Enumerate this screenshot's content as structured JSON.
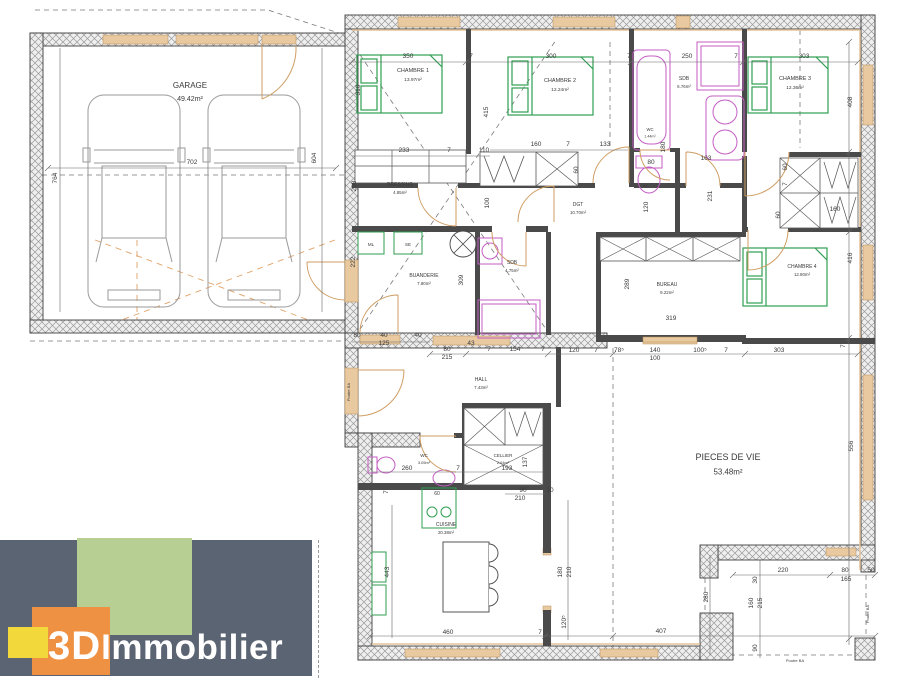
{
  "logo": {
    "bold": "3D",
    "rest": "Immobilier",
    "colors": {
      "panel": "#5b6472",
      "green": "#b7cf92",
      "orange": "#ef9143",
      "yellow": "#f2d83a",
      "text": "#ffffff"
    }
  },
  "palette": {
    "wall_hatch": "#9a9a9a",
    "interior_wall": "#4a4a4a",
    "opening_tan": "#e8c9a0",
    "furniture_green": "#2f9e52",
    "sanitary_magenta": "#c45ec4",
    "door_tan": "#cf9e63"
  },
  "rooms": [
    {
      "name": "GARAGE",
      "area": "49.42m²",
      "x": 190,
      "y": 88,
      "fs": 8
    },
    {
      "name": "CHAMBRE 1",
      "area": "13.97m²",
      "x": 413,
      "y": 72,
      "fs": 5.5
    },
    {
      "name": "CHAMBRE 2",
      "area": "12.24m²",
      "x": 560,
      "y": 82,
      "fs": 5.5
    },
    {
      "name": "SDB",
      "area": "6.76m²",
      "x": 684,
      "y": 80,
      "fs": 5
    },
    {
      "name": "WC",
      "area": "1.44m²",
      "x": 650,
      "y": 131,
      "fs": 4.2
    },
    {
      "name": "CHAMBRE 3",
      "area": "12.36m²",
      "x": 795,
      "y": 80,
      "fs": 5.5
    },
    {
      "name": "DRESSING",
      "area": "4.85m²",
      "x": 400,
      "y": 186,
      "fs": 5
    },
    {
      "name": "DGT",
      "area": "10.70m²",
      "x": 578,
      "y": 206,
      "fs": 5
    },
    {
      "name": "BUANDERIE",
      "area": "7.80m²",
      "x": 424,
      "y": 277,
      "fs": 5
    },
    {
      "name": "SDB",
      "area": "4.75m²",
      "x": 512,
      "y": 264,
      "fs": 5
    },
    {
      "name": "BUREAU",
      "area": "9.22m²",
      "x": 667,
      "y": 286,
      "fs": 5
    },
    {
      "name": "CHAMBRE 4",
      "area": "12.80m²",
      "x": 802,
      "y": 268,
      "fs": 5
    },
    {
      "name": "HALL",
      "area": "7.43m²",
      "x": 481,
      "y": 381,
      "fs": 5
    },
    {
      "name": "WC",
      "area": "3.05m²",
      "x": 424,
      "y": 457,
      "fs": 4.5
    },
    {
      "name": "CELLIER",
      "area": "2.64m²",
      "x": 503,
      "y": 457,
      "fs": 4.5
    },
    {
      "name": "CUISINE",
      "area": "20.38m²",
      "x": 446,
      "y": 526,
      "fs": 5
    },
    {
      "name": "PIECES DE VIE",
      "area": "53.48m²",
      "x": 728,
      "y": 460,
      "fs": 9
    }
  ],
  "annotations": [
    {
      "t": "350",
      "x": 408,
      "y": 58
    },
    {
      "t": "7",
      "x": 471,
      "y": 58
    },
    {
      "t": "300",
      "x": 551,
      "y": 58
    },
    {
      "t": "7",
      "x": 629,
      "y": 58
    },
    {
      "t": "250",
      "x": 687,
      "y": 58
    },
    {
      "t": "7",
      "x": 736,
      "y": 58
    },
    {
      "t": "303",
      "x": 804,
      "y": 58
    },
    {
      "t": "702",
      "x": 192,
      "y": 164
    },
    {
      "t": "604",
      "x": 316,
      "y": 158,
      "r": 1
    },
    {
      "t": "764",
      "x": 57,
      "y": 178,
      "r": 1
    },
    {
      "t": "310",
      "x": 360,
      "y": 90,
      "r": 1
    },
    {
      "t": "415",
      "x": 488,
      "y": 112,
      "r": 1
    },
    {
      "t": "233",
      "x": 404,
      "y": 152
    },
    {
      "t": "7",
      "x": 449,
      "y": 152
    },
    {
      "t": "110",
      "x": 484,
      "y": 152
    },
    {
      "t": "160",
      "x": 536,
      "y": 146
    },
    {
      "t": "7",
      "x": 568,
      "y": 146
    },
    {
      "t": "133",
      "x": 605,
      "y": 146
    },
    {
      "t": "60",
      "x": 578,
      "y": 170,
      "r": 1
    },
    {
      "t": "80",
      "x": 651,
      "y": 164
    },
    {
      "t": "163",
      "x": 706,
      "y": 160
    },
    {
      "t": "231",
      "x": 712,
      "y": 196,
      "r": 1
    },
    {
      "t": "60",
      "x": 787,
      "y": 167,
      "r": 1
    },
    {
      "t": "7",
      "x": 787,
      "y": 184,
      "r": 1
    },
    {
      "t": "60",
      "x": 780,
      "y": 215,
      "r": 1
    },
    {
      "t": "160",
      "x": 835,
      "y": 211
    },
    {
      "t": "408",
      "x": 852,
      "y": 102,
      "r": 1
    },
    {
      "t": "416",
      "x": 852,
      "y": 258,
      "r": 1
    },
    {
      "t": "7",
      "x": 845,
      "y": 346,
      "r": 1
    },
    {
      "t": "208",
      "x": 356,
      "y": 186,
      "r": 1
    },
    {
      "t": "100",
      "x": 489,
      "y": 203,
      "r": 1
    },
    {
      "t": "222",
      "x": 355,
      "y": 262,
      "r": 1
    },
    {
      "t": "309",
      "x": 463,
      "y": 280,
      "r": 1
    },
    {
      "t": "180",
      "x": 665,
      "y": 147,
      "r": 1
    },
    {
      "t": "7",
      "x": 648,
      "y": 186,
      "r": 1
    },
    {
      "t": "120",
      "x": 648,
      "y": 207,
      "r": 1
    },
    {
      "t": "289",
      "x": 629,
      "y": 284,
      "r": 1
    },
    {
      "t": "319",
      "x": 671,
      "y": 320
    },
    {
      "t": "80",
      "x": 357,
      "y": 337
    },
    {
      "t": "40",
      "x": 384,
      "y": 337
    },
    {
      "t": "125",
      "x": 384,
      "y": 345
    },
    {
      "t": "40",
      "x": 418,
      "y": 337
    },
    {
      "t": "43",
      "x": 471,
      "y": 345
    },
    {
      "t": "80",
      "x": 447,
      "y": 351
    },
    {
      "t": "215",
      "x": 447,
      "y": 359
    },
    {
      "t": "7",
      "x": 489,
      "y": 351
    },
    {
      "t": "154",
      "x": 515,
      "y": 351
    },
    {
      "t": "7",
      "x": 543,
      "y": 351
    },
    {
      "t": "120",
      "x": 574,
      "y": 352
    },
    {
      "t": "7",
      "x": 596,
      "y": 352
    },
    {
      "t": "78⁵",
      "x": 619,
      "y": 352
    },
    {
      "t": "140",
      "x": 655,
      "y": 352
    },
    {
      "t": "100",
      "x": 655,
      "y": 360
    },
    {
      "t": "100⁵",
      "x": 700,
      "y": 352
    },
    {
      "t": "7",
      "x": 726,
      "y": 352
    },
    {
      "t": "303",
      "x": 779,
      "y": 352
    },
    {
      "t": "260",
      "x": 407,
      "y": 470
    },
    {
      "t": "7",
      "x": 458,
      "y": 470
    },
    {
      "t": "193",
      "x": 507,
      "y": 470
    },
    {
      "t": "137",
      "x": 527,
      "y": 462,
      "r": 1
    },
    {
      "t": "90",
      "x": 523,
      "y": 492
    },
    {
      "t": "210",
      "x": 520,
      "y": 500
    },
    {
      "t": "10",
      "x": 550,
      "y": 492
    },
    {
      "t": "7",
      "x": 388,
      "y": 492,
      "r": 1
    },
    {
      "t": "60",
      "x": 437,
      "y": 495,
      "fs": 5
    },
    {
      "t": "443",
      "x": 389,
      "y": 572,
      "r": 1
    },
    {
      "t": "460",
      "x": 448,
      "y": 634
    },
    {
      "t": "7",
      "x": 540,
      "y": 634
    },
    {
      "t": "120⁵",
      "x": 566,
      "y": 622,
      "r": 1
    },
    {
      "t": "180",
      "x": 562,
      "y": 572,
      "r": 1
    },
    {
      "t": "210",
      "x": 571,
      "y": 572,
      "r": 1
    },
    {
      "t": "407",
      "x": 661,
      "y": 633
    },
    {
      "t": "556",
      "x": 853,
      "y": 446,
      "r": 1
    },
    {
      "t": "280",
      "x": 708,
      "y": 597,
      "r": 1
    },
    {
      "t": "220",
      "x": 783,
      "y": 572
    },
    {
      "t": "80",
      "x": 845,
      "y": 572
    },
    {
      "t": "50",
      "x": 871,
      "y": 572
    },
    {
      "t": "165",
      "x": 846,
      "y": 581
    },
    {
      "t": "30",
      "x": 757,
      "y": 580,
      "r": 1
    },
    {
      "t": "160",
      "x": 753,
      "y": 603,
      "r": 1
    },
    {
      "t": "215",
      "x": 762,
      "y": 603,
      "r": 1
    },
    {
      "t": "90",
      "x": 757,
      "y": 648,
      "r": 1
    },
    {
      "t": "Poutre BA",
      "x": 350,
      "y": 392,
      "r": 1,
      "fs": 4,
      "n": "beam-label"
    },
    {
      "t": "Poutre BA",
      "x": 869,
      "y": 614,
      "r": 1,
      "fs": 4,
      "n": "beam-label"
    },
    {
      "t": "Poutre BA",
      "x": 795,
      "y": 662,
      "fs": 4,
      "n": "beam-label"
    },
    {
      "t": "ML",
      "x": 371,
      "y": 246,
      "fs": 4.5,
      "n": "washer-label"
    },
    {
      "t": "SE",
      "x": 408,
      "y": 246,
      "fs": 4.5,
      "n": "dryer-label"
    }
  ]
}
